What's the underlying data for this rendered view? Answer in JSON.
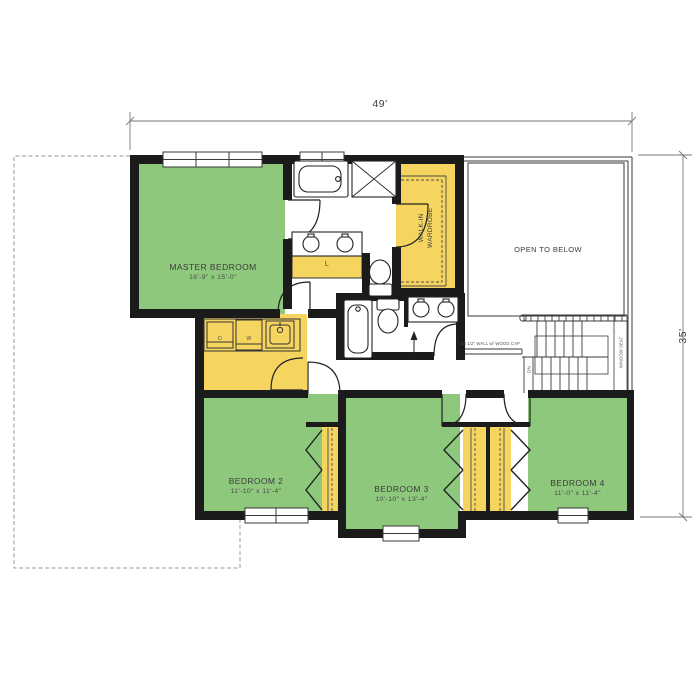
{
  "plan": {
    "title": "second-floor-plan",
    "dimensions": {
      "width": "49'",
      "height": "35'"
    },
    "rooms": {
      "master": {
        "name": "MASTER BEDROOM",
        "dims": "16'-9\" x 15'-0\""
      },
      "bed2": {
        "name": "BEDROOM 2",
        "dims": "11'-10\" x 11'-4\""
      },
      "bed3": {
        "name": "BEDROOM 3",
        "dims": "10'-10\" x 13'-4\""
      },
      "bed4": {
        "name": "BEDROOM 4",
        "dims": "11'-0\" x 11'-4\""
      },
      "wardrobe": {
        "line1": "WALK-IN",
        "line2": "WARDROBE"
      },
      "open_below": {
        "name": "OPEN TO BELOW"
      }
    },
    "annotations": {
      "linen": "L",
      "dryer": "D",
      "washer": "W",
      "down": "DN",
      "window_seat": "WINDOW SEAT",
      "wall_cap": "44 1/2\" WALL w/ WOOD CAP"
    },
    "colors": {
      "room_green": "#8EC87C",
      "closet_yellow": "#F5D55F",
      "wall_black": "#1B1B1B",
      "line_gray": "#3a3a3a",
      "dim_gray": "#8a8a8a"
    }
  }
}
